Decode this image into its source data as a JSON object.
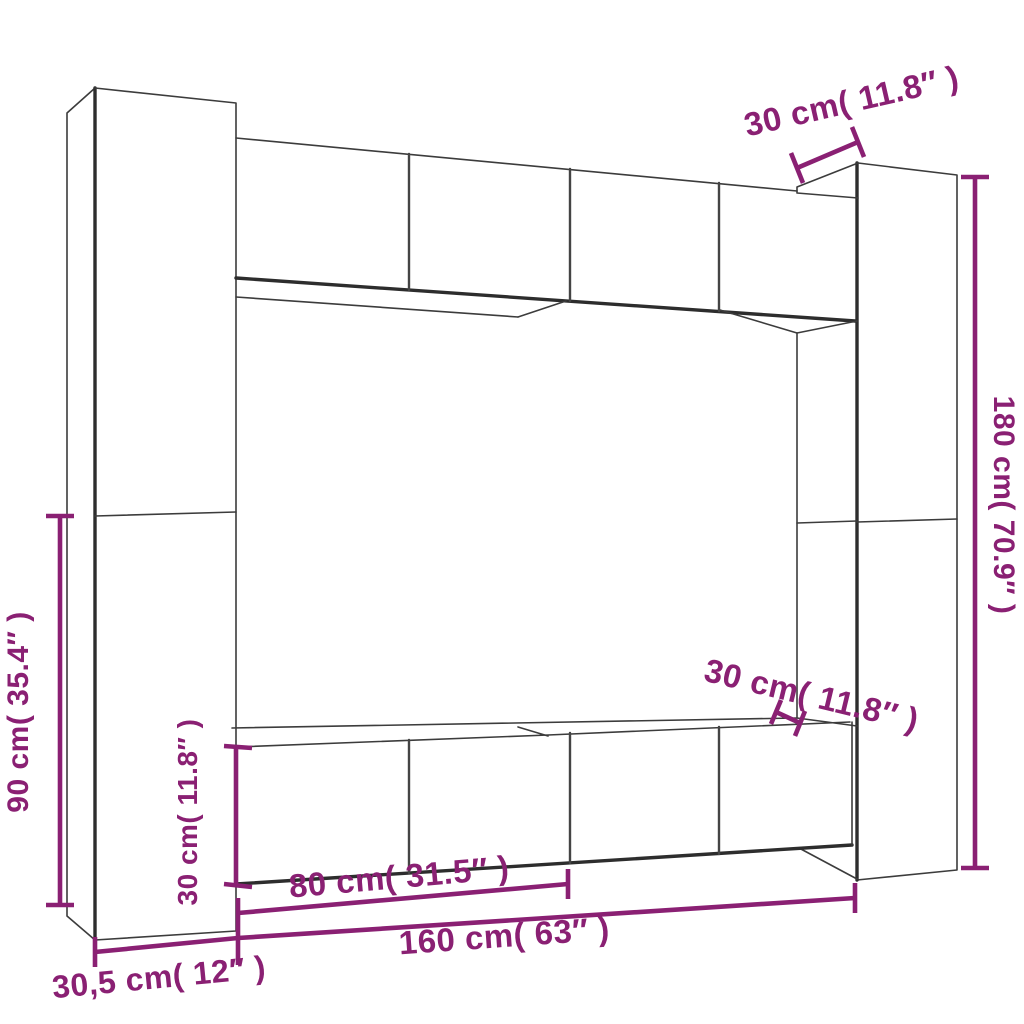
{
  "colors": {
    "background": "#ffffff",
    "outline": "#3c3c3c",
    "dimension_accent": "#8a2073"
  },
  "dimensions": {
    "top_depth": {
      "label": "30 cm( 11.8″ )"
    },
    "right_height": {
      "label": "180 cm( 70.9″ )"
    },
    "left_height": {
      "label": "90 cm( 35.4″ )"
    },
    "left_cabinet_height": {
      "label": "30 cm( 11.8″ )"
    },
    "right_depth": {
      "label": "30 cm( 11.8″ )"
    },
    "door_pair_width": {
      "label": "80 cm( 31.5″ )"
    },
    "row_width": {
      "label": "160 cm( 63″ )"
    },
    "column_width": {
      "label": "30,5 cm( 12″ )"
    }
  }
}
